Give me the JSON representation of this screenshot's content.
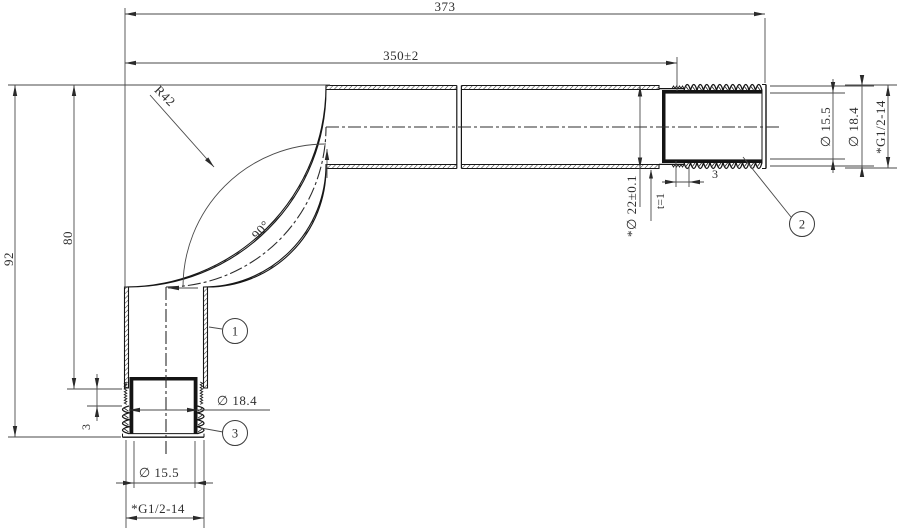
{
  "drawing": {
    "dims": {
      "overall_length": "373",
      "straight_length": "350±2",
      "bend_radius": "R42",
      "bend_angle": "90°",
      "overall_height": "92",
      "height_to_thread_shoulder": "80",
      "shoulder_length_bottom": "3",
      "shoulder_length_right": "3",
      "tube_diameter": "*∅ 22±0.1",
      "wall_thickness": "t=1",
      "right_end_bore": "∅ 15.5",
      "right_end_od": "∅ 18.4",
      "right_end_thread": "*G1/2-14",
      "bottom_end_od": "∅ 18.4",
      "bottom_end_bore": "∅ 15.5",
      "bottom_end_thread": "*G1/2-14"
    },
    "balloons": [
      {
        "label": "1"
      },
      {
        "label": "2"
      },
      {
        "label": "3"
      }
    ]
  }
}
